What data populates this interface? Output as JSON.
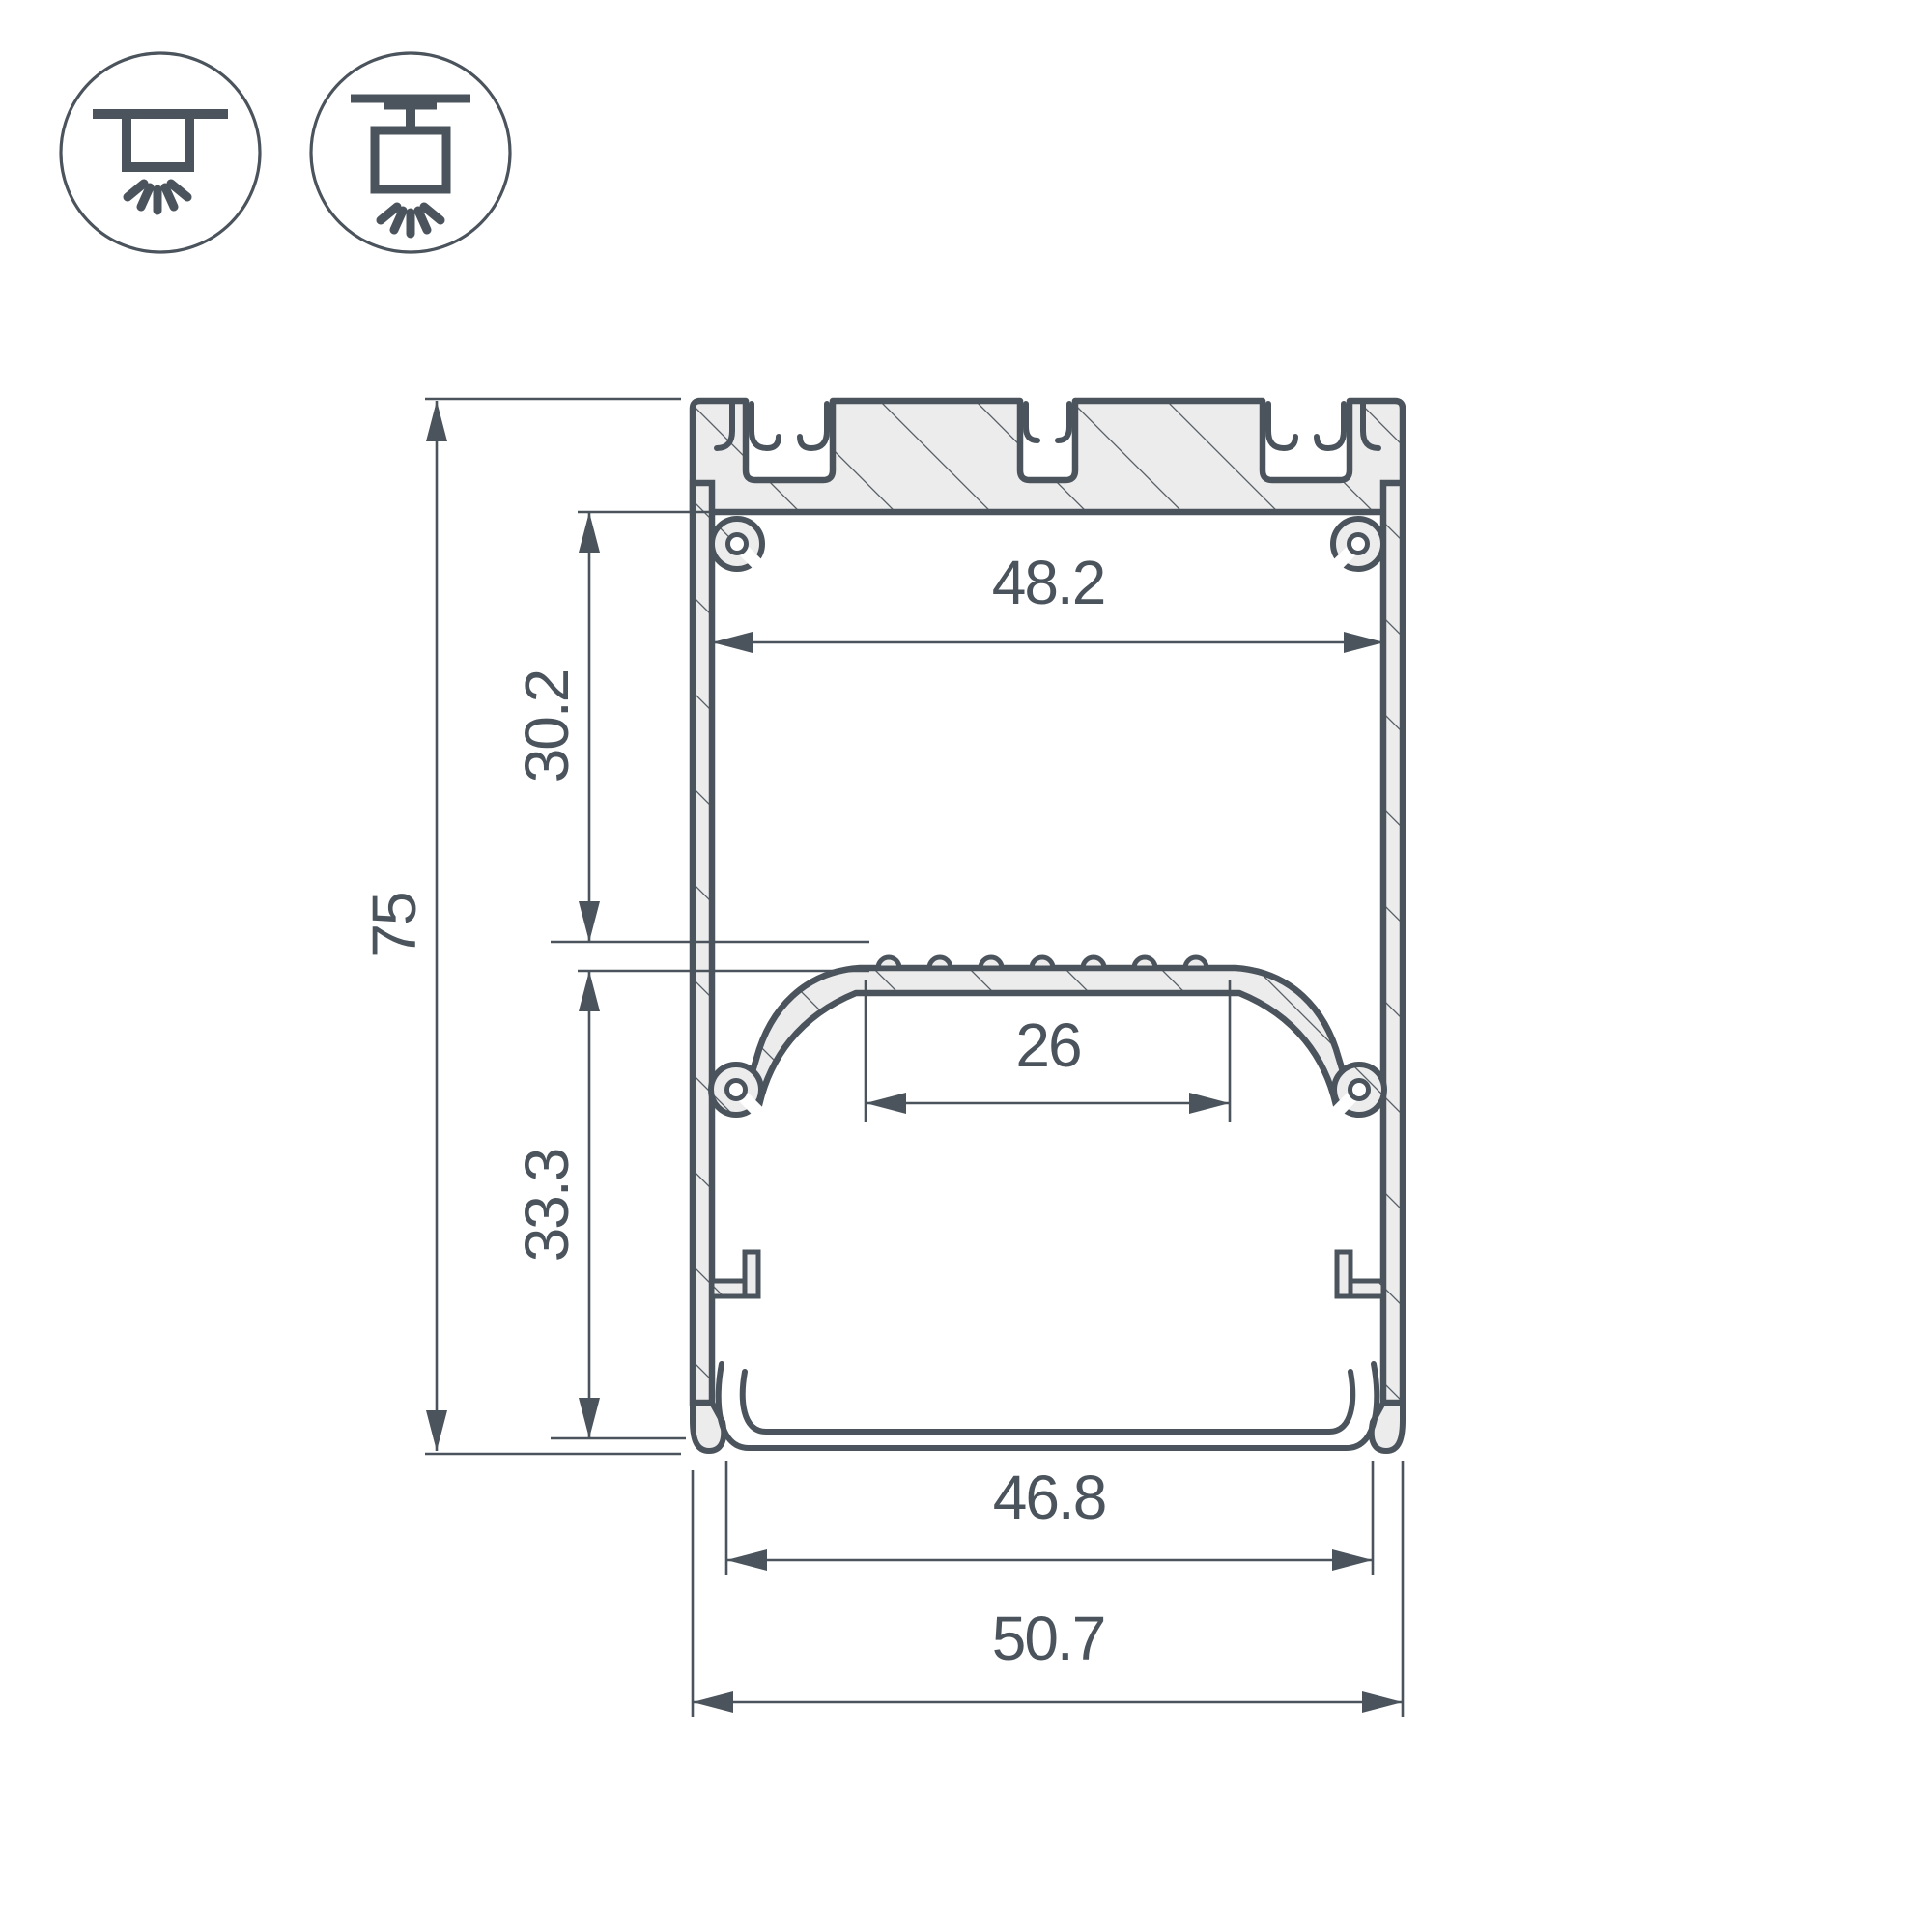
{
  "page": {
    "background": "#ffffff"
  },
  "colors": {
    "line": "#4b545c",
    "metal_fill": "#ececec",
    "hatch": "#4b545c"
  },
  "mounting_icons": {
    "surface": {
      "name": "surface-mount-icon"
    },
    "pendant": {
      "name": "pendant-mount-icon"
    }
  },
  "drawing": {
    "type": "led-profile-cross-section",
    "dimensions": {
      "overall_height": {
        "label": "75"
      },
      "upper_cavity_height": {
        "label": "30.2"
      },
      "lower_cavity_height": {
        "label": "33.3"
      },
      "inner_top_width": {
        "label": "48.2"
      },
      "led_platform_width": {
        "label": "26"
      },
      "bottom_opening_width": {
        "label": "46.8"
      },
      "overall_width": {
        "label": "50.7"
      }
    }
  }
}
